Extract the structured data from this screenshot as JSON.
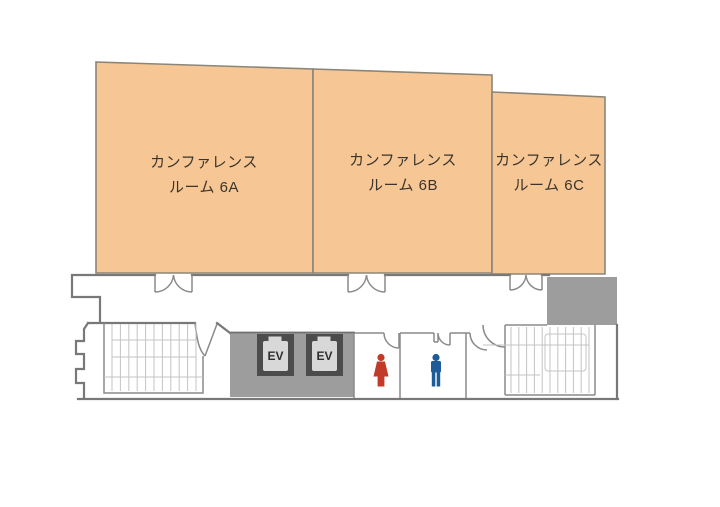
{
  "floor_plan": {
    "rooms": [
      {
        "id": "6A",
        "name_line1": "カンファレンス",
        "name_line2": "ルーム 6A"
      },
      {
        "id": "6B",
        "name_line1": "カンファレンス",
        "name_line2": "ルーム 6B"
      },
      {
        "id": "6C",
        "name_line1": "カンファレンス",
        "name_line2": "ルーム 6C"
      }
    ],
    "elevator": {
      "label": "EV",
      "count": 2
    },
    "icons": {
      "womens_restroom": "female-icon",
      "mens_restroom": "male-icon"
    },
    "colors": {
      "room_fill": "#F6C695",
      "room_border": "#8B8579",
      "wall": "#787878",
      "service_area_gray": "#9D9D9D",
      "elevator_shaft": "#4C4C4C",
      "elevator_cab": "#D8D8D8",
      "female_icon": "#C23A28",
      "male_icon": "#1E5C99",
      "stair_lines": "#C3C3C3",
      "label_text": "#3A352C"
    }
  }
}
